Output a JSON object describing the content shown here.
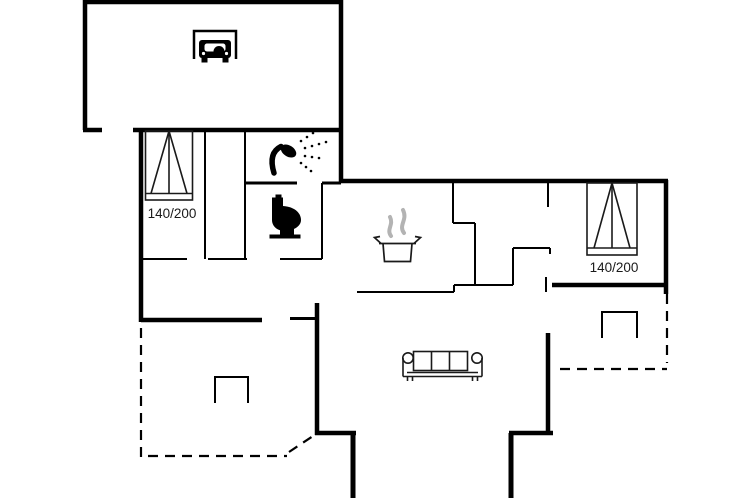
{
  "floorplan": {
    "background_color": "#ffffff",
    "wall_color": "#000000",
    "steam_color": "#b3b3b3",
    "text_color": "#1a1a1a",
    "beds": [
      {
        "id": "left-bedroom-bed",
        "label": "140/200"
      },
      {
        "id": "right-bedroom-bed",
        "label": "140/200"
      }
    ],
    "icons": [
      {
        "name": "car-garage-icon"
      },
      {
        "name": "double-bed-icon-left"
      },
      {
        "name": "shower-icon"
      },
      {
        "name": "toilet-icon"
      },
      {
        "name": "cooking-pot-icon"
      },
      {
        "name": "steam-icon"
      },
      {
        "name": "double-bed-icon-right"
      },
      {
        "name": "sofa-icon"
      },
      {
        "name": "terrace-marker-icon-left"
      },
      {
        "name": "terrace-marker-icon-right"
      }
    ]
  }
}
